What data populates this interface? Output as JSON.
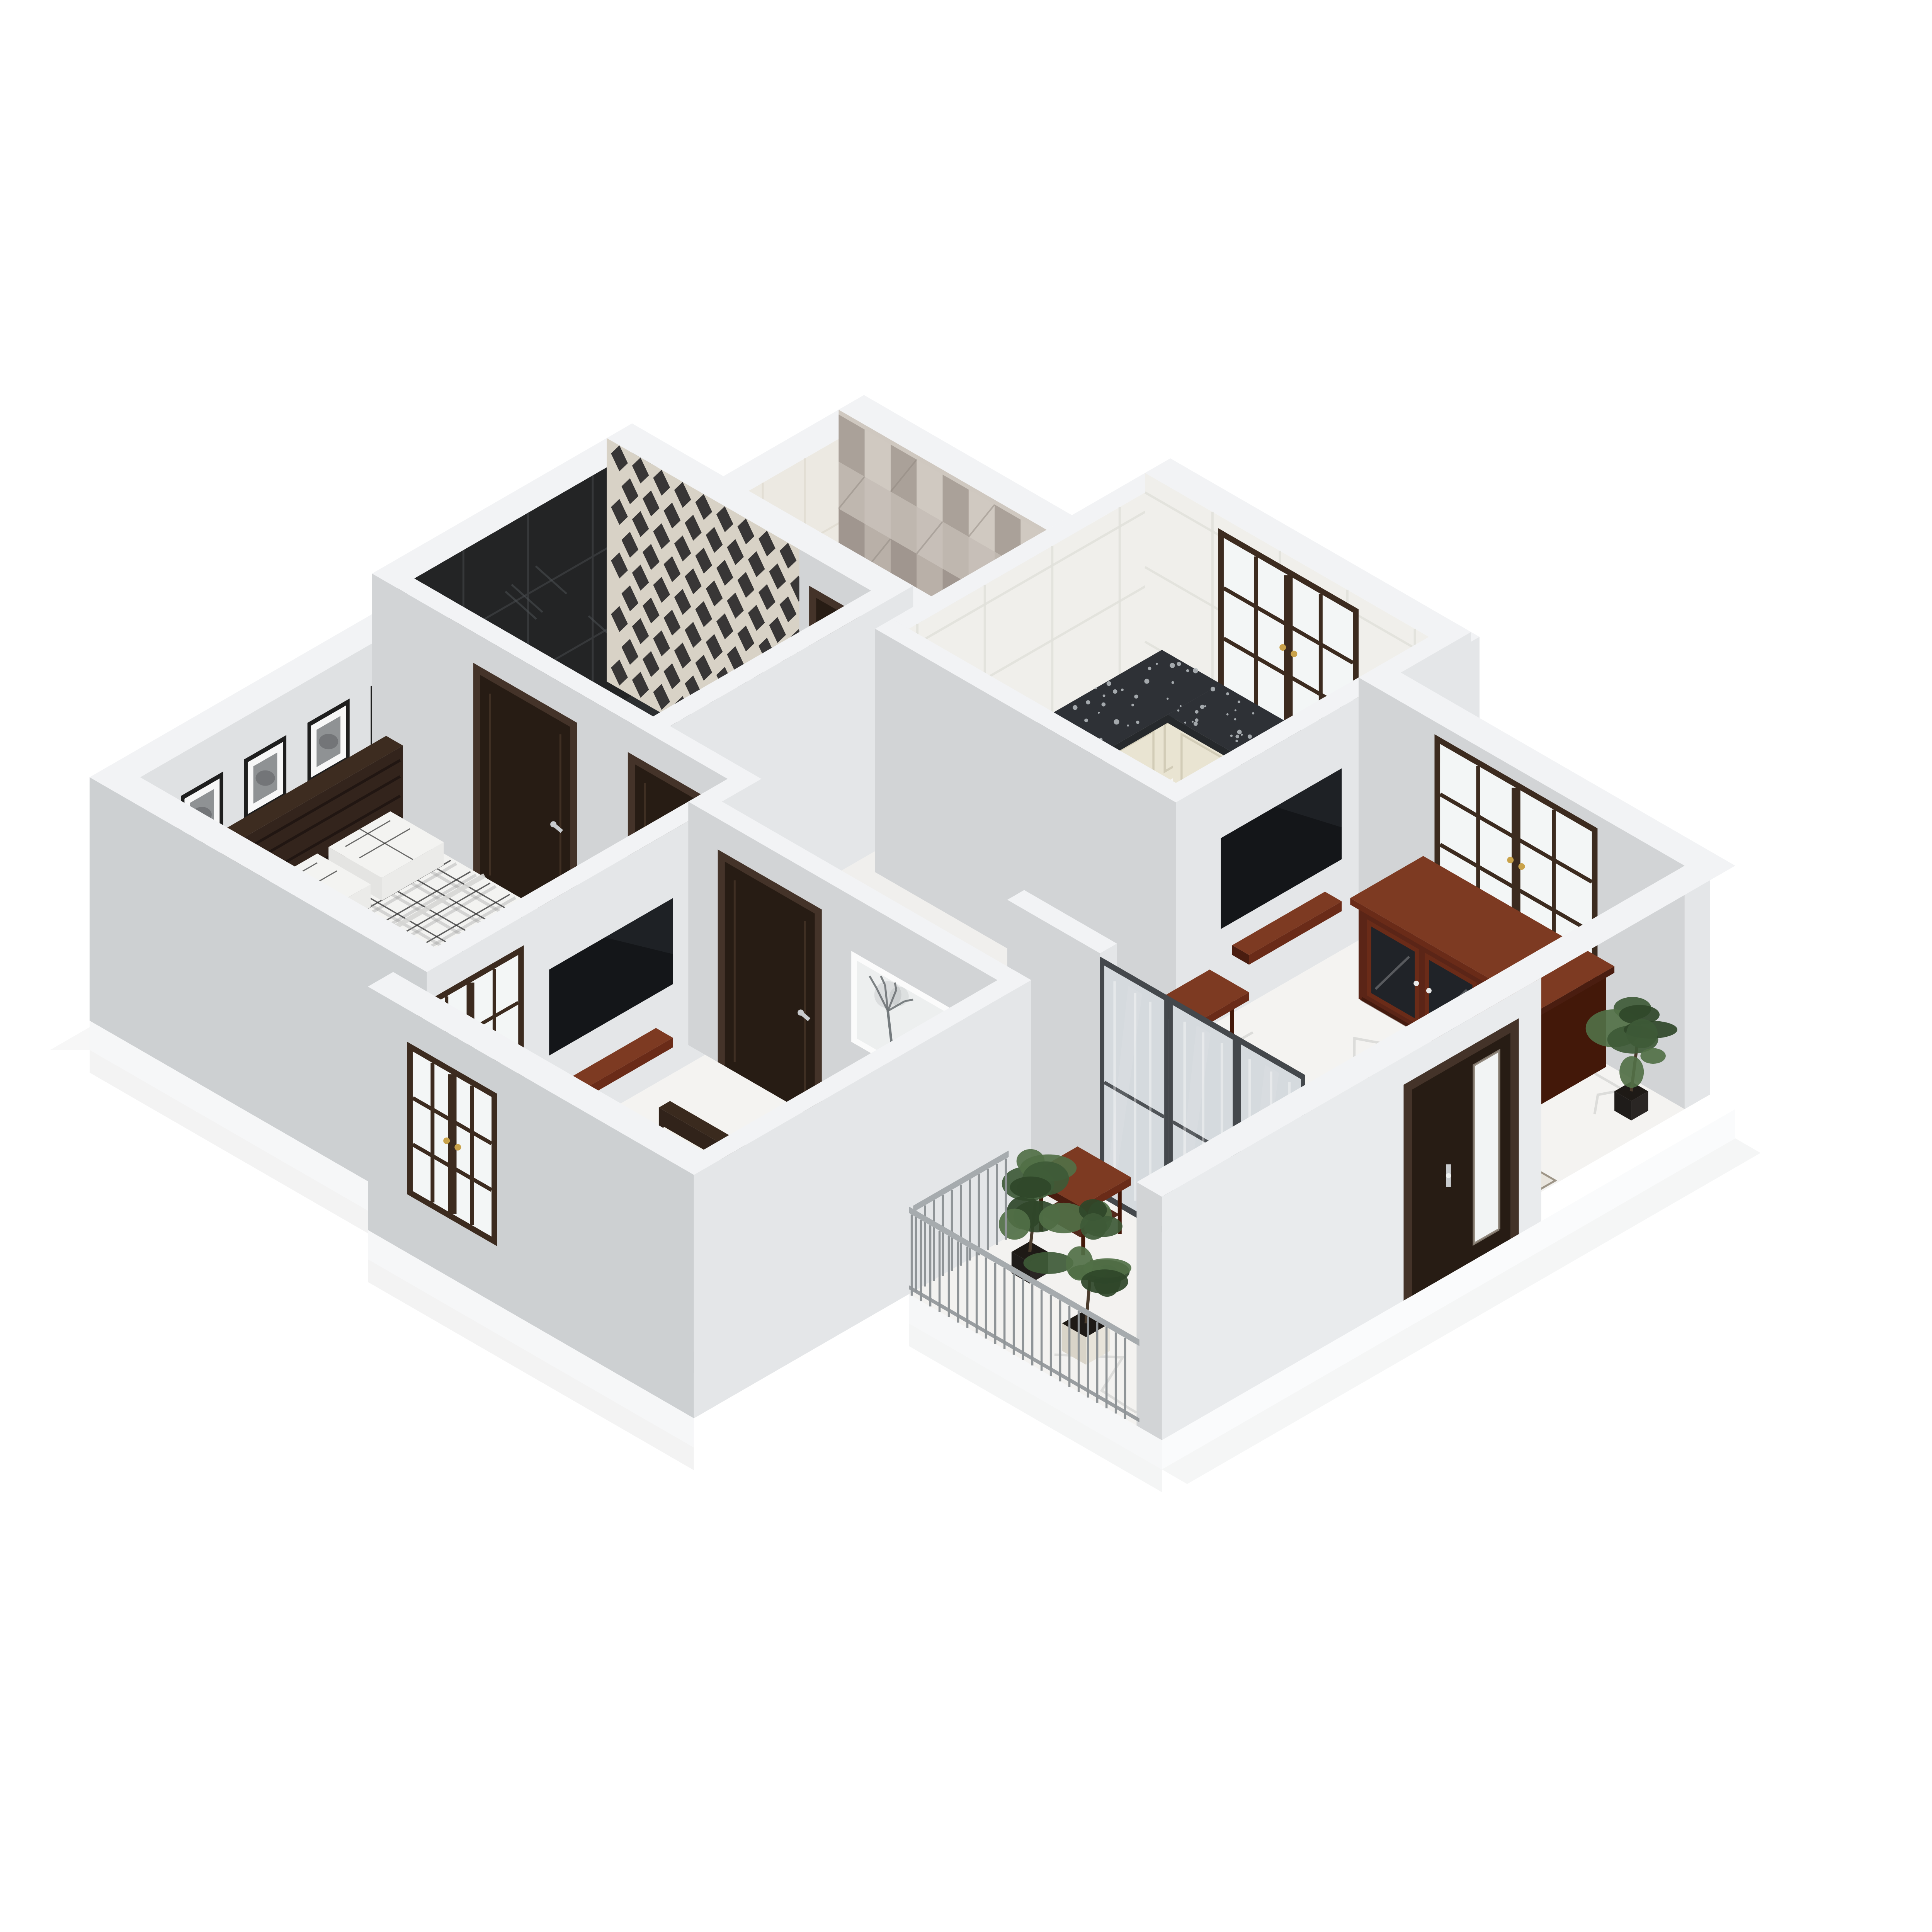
{
  "scene": {
    "title": "3D isometric cutaway floor plan render of an apartment",
    "type": "architectural-3d-floor-plan",
    "background": "#ffffff"
  },
  "palette": {
    "wall_lit": "#e4e6e8",
    "wall_shade": "#d2d4d6",
    "wall_top": "#f2f3f5",
    "wall_bright": "#e9ebed",
    "slab_y": "#f6f7f8",
    "slab_x": "#fafbfc",
    "shadow": "#e7e8e8",
    "floor_marble": "#f4f3f1",
    "floor_hall": "#f0efed",
    "floor_kitchen": "#f6f5f3",
    "marble_vein": "#d9d9d7",
    "bath_floor": "#2c2e30",
    "bath_floor_line": "#3b3d3f",
    "black_marble": "#232425",
    "black_marble_streak": "#4d5153",
    "black_marble_line": "#36383a",
    "diamond_base": "#d8d2c6",
    "diamond_dark": "#2f2d2e",
    "patch_base": "#cfc8c0",
    "patch_shades": [
      "#c6bfb7",
      "#b7afa7",
      "#a89f97",
      "#beb6ae",
      "#9d948c",
      "#d0c9c1"
    ],
    "tile_white": "#f0efeb",
    "tile_line": "#e1e0da",
    "tile_cream": "#ece9e2",
    "cab_cream": "#e9e4d2",
    "cab_cream_dark": "#dcd6c2",
    "cab_line": "#cfc9b4",
    "granite": "#2e3136",
    "granite_edge": "#26292c",
    "granite_fleck": "#b9bec2",
    "door_wood": "#271c14",
    "door_frame": "#443329",
    "door_groove": "#53402f",
    "silver": "#c8cbce",
    "gold": "#c9a24a",
    "window_frame": "#3c2b1f",
    "glass": "#f3f6f6",
    "mahogany": "#6a2b18",
    "mahogany_dark": "#4a1d10",
    "mahogany_deep": "#431809",
    "mahogany_top": "#7d3a22",
    "tv": "#141619",
    "tv_gloss": "#3a3f45",
    "plaid_base": "#f3f3f1",
    "plaid_dark": "#2e2e2e",
    "plaid_gray": "#8e8e8e",
    "bed_side": "#e4e4e2",
    "bed_white": "#f3f1ea",
    "bed_white_side": "#e7e5de",
    "bed_frame": "#33251c",
    "bed_frame_dark": "#2a1e16",
    "headboard": "#33241c",
    "headboard_line": "#1f1410",
    "frame_black": "#1e1e1e",
    "mat_white": "#f7f7f7",
    "photo_gray": "#8f9294",
    "photo_dark": "#6b6e70",
    "art_bg": "#edefef",
    "art_tree": "#6f7477",
    "art_frame": "#fbfbfb",
    "rug": "#e9e5de",
    "rug_line": "#9a9183",
    "slide_frame": "#44484c",
    "slide_frame_dark": "#3a3e42",
    "slide_glass": "#dde3e6",
    "railing": "#8f9497",
    "railing_rail": "#a6abae",
    "leaf1": "#3e5a37",
    "leaf2": "#517047",
    "leaf3": "#2f4729",
    "trunk": "#4a3b2c",
    "pot_white": "#e8e4da",
    "pot_white_side": "#d9d4c8",
    "pot_dark": "#2a2624",
    "pot_dark_side": "#1f1c1a",
    "soil": "#1e1a16"
  },
  "rooms": [
    {
      "id": "bathroom-accent",
      "label": "Bathroom 1",
      "features": [
        "black-marble-wall-tile",
        "diamond-pattern-wall-tile",
        "dark-marble-floor",
        "dark-walnut-door"
      ]
    },
    {
      "id": "bathroom-2",
      "label": "Bathroom 2",
      "features": [
        "patchwork-pattern-wall-tile",
        "cream-tile-wall",
        "dark-walnut-door"
      ]
    },
    {
      "id": "kitchen",
      "label": "Kitchen",
      "features": [
        "white-tile-walls",
        "l-shaped-counter",
        "black-granite-countertop",
        "cream-panel-cabinets",
        "dark-wood-casement-window-gold-handles"
      ]
    },
    {
      "id": "master-bedroom",
      "label": "Master Bedroom",
      "features": [
        "double-bed-plaid-bedding",
        "two-plaid-pillows",
        "wood-slat-headboard",
        "four-framed-bw-photos",
        "foot-of-bed-wood-bench",
        "window",
        "dark-walnut-door",
        "white-marble-floor"
      ]
    },
    {
      "id": "living-room",
      "label": "Living Room",
      "features": [
        "wall-mounted-tv",
        "floating-media-shelf",
        "carved-console-table",
        "casement-window",
        "mahogany-sideboard-glass-doors",
        "geometric-pattern-rug",
        "potted-plant",
        "entry-door-with-glass-sidelite",
        "sliding-glass-balcony-door"
      ]
    },
    {
      "id": "bedroom-2",
      "label": "Bedroom 2",
      "features": [
        "wall-mounted-tv",
        "floating-media-shelf",
        "bed-white-mattress-dark-frame",
        "framed-tree-artwork",
        "interior-window",
        "south-window",
        "dark-walnut-door"
      ]
    },
    {
      "id": "balcony",
      "label": "Balcony",
      "features": [
        "metal-railing",
        "wood-side-table",
        "potted-plant-dark-pot",
        "potted-plant-white-pot",
        "white-marble-floor"
      ]
    }
  ]
}
